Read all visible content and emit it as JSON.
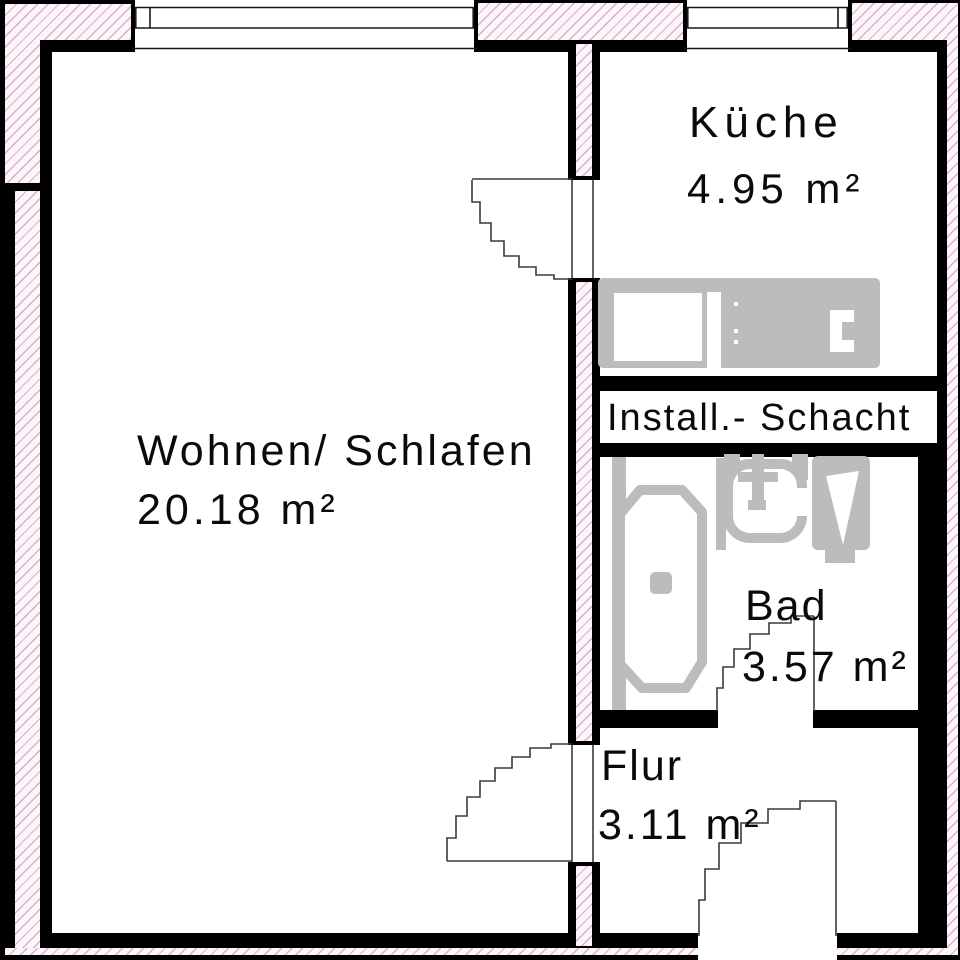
{
  "plan": {
    "type": "floor-plan",
    "rooms": [
      {
        "id": "wohnen-schlafen",
        "label": "Wohnen/ Schlafen",
        "area": "20.18 m²"
      },
      {
        "id": "kueche",
        "label": "Küche",
        "area": "4.95 m²"
      },
      {
        "id": "bad",
        "label": "Bad",
        "area": "3.57 m²"
      },
      {
        "id": "flur",
        "label": "Flur",
        "area": "3.11 m²"
      },
      {
        "id": "install-schacht",
        "label": "Install.- Schacht"
      }
    ],
    "colors": {
      "wall": "#000000",
      "fixtures": "#bcbcbc",
      "hatch_line": "#cf9fc4",
      "hatch_bg": "#fcf6fa"
    }
  }
}
